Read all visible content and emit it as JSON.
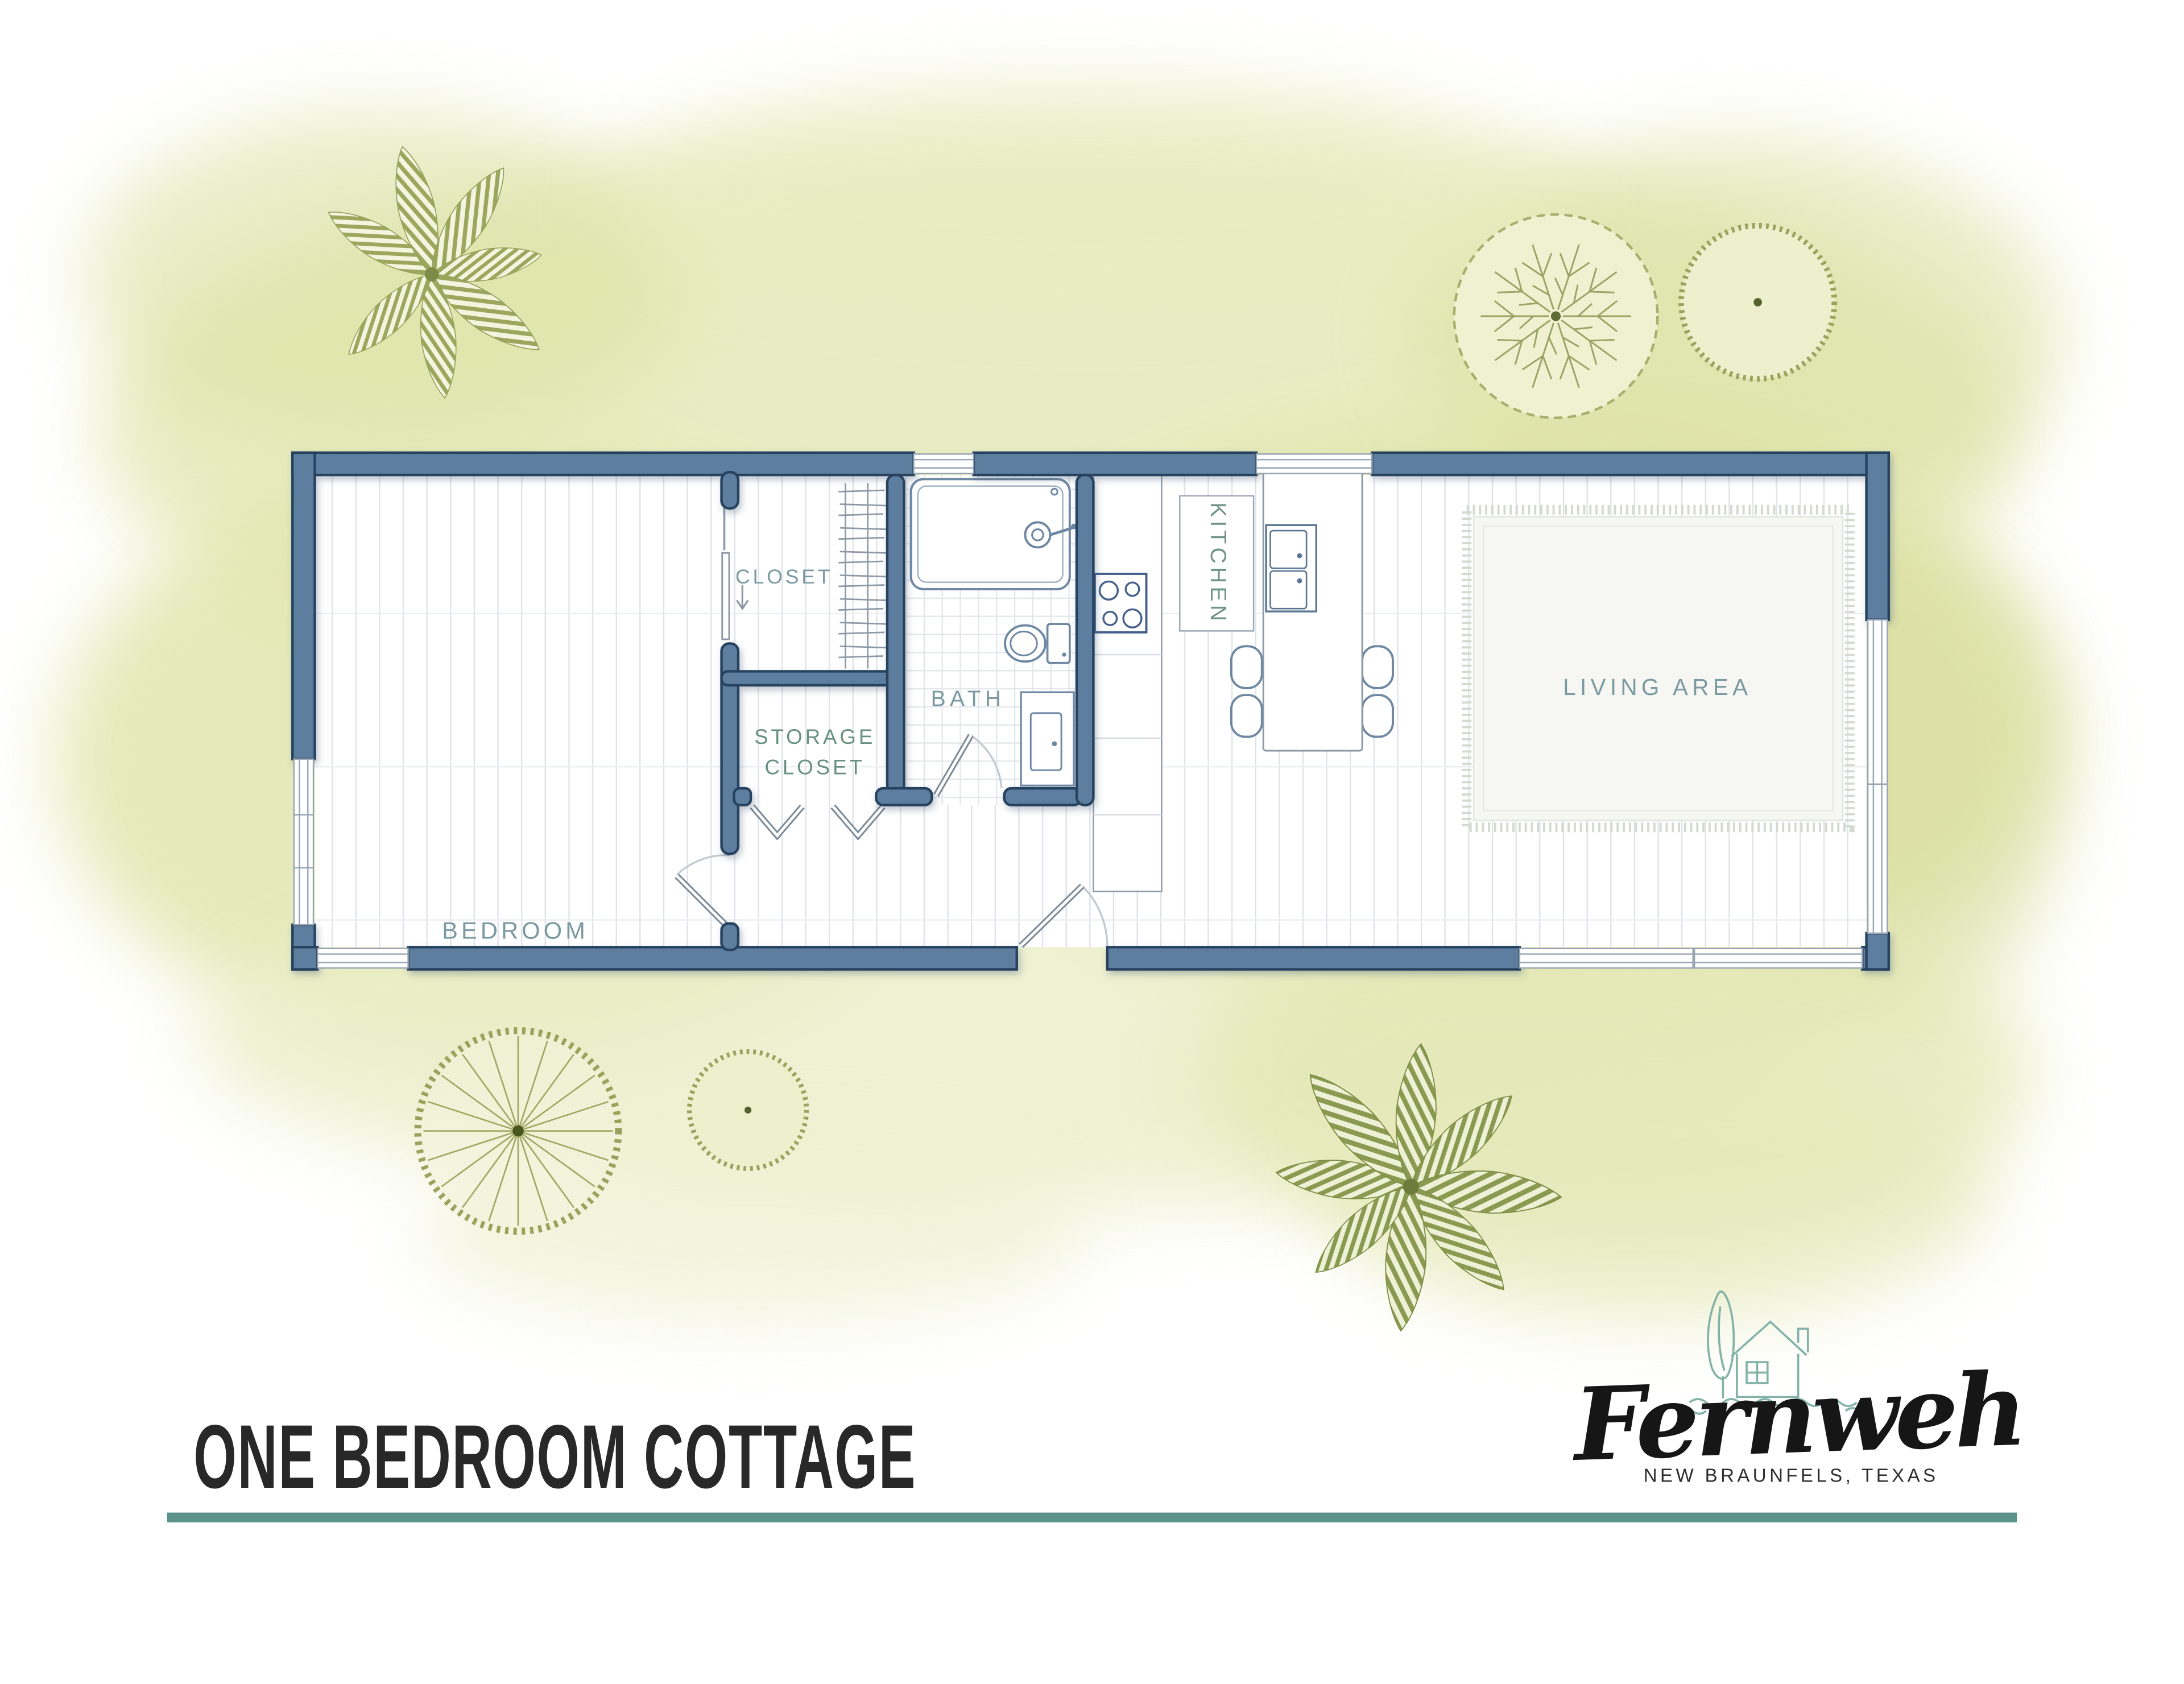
{
  "title": "ONE BEDROOM COTTAGE",
  "accent_rule_color": "#5b9289",
  "brand": {
    "name": "Fernweh",
    "location": "NEW BRAUNFELS, TEXAS",
    "logo_icon": "cottage-and-tree-icon"
  },
  "floor_plan": {
    "rooms": [
      {
        "id": "bedroom",
        "label": "BEDROOM"
      },
      {
        "id": "closet",
        "label": "CLOSET"
      },
      {
        "id": "storage_closet",
        "label_line1": "STORAGE",
        "label_line2": "CLOSET"
      },
      {
        "id": "bath",
        "label": "BATH"
      },
      {
        "id": "kitchen",
        "label": "KITCHEN"
      },
      {
        "id": "living_area",
        "label": "LIVING AREA"
      }
    ],
    "fixtures": [
      "shower",
      "toilet",
      "vanity-sink",
      "cooktop-4-burner",
      "kitchen-counter",
      "island-with-4-stools",
      "island-cabinet",
      "area-rug",
      "closet-hanging-rod",
      "sliding-closet-door",
      "bifold-doors",
      "entry-door",
      "bedroom-door",
      "bath-door",
      "windows"
    ],
    "colors": {
      "wall_fill": "#5d7e9e",
      "wall_outline": "#26425f",
      "label_teal": "#7b99a1",
      "label_green": "#689180",
      "floor_line": "#e0e4ea"
    }
  },
  "decor": {
    "background_wash_color": "#e6e9b8",
    "trees": [
      {
        "id": "palm-plant-top-left"
      },
      {
        "id": "branched-tree-top-right"
      },
      {
        "id": "round-shrub-top-right"
      },
      {
        "id": "spoke-tree-bottom-left"
      },
      {
        "id": "round-shrub-bottom-left"
      },
      {
        "id": "palm-plant-bottom-right"
      }
    ]
  }
}
